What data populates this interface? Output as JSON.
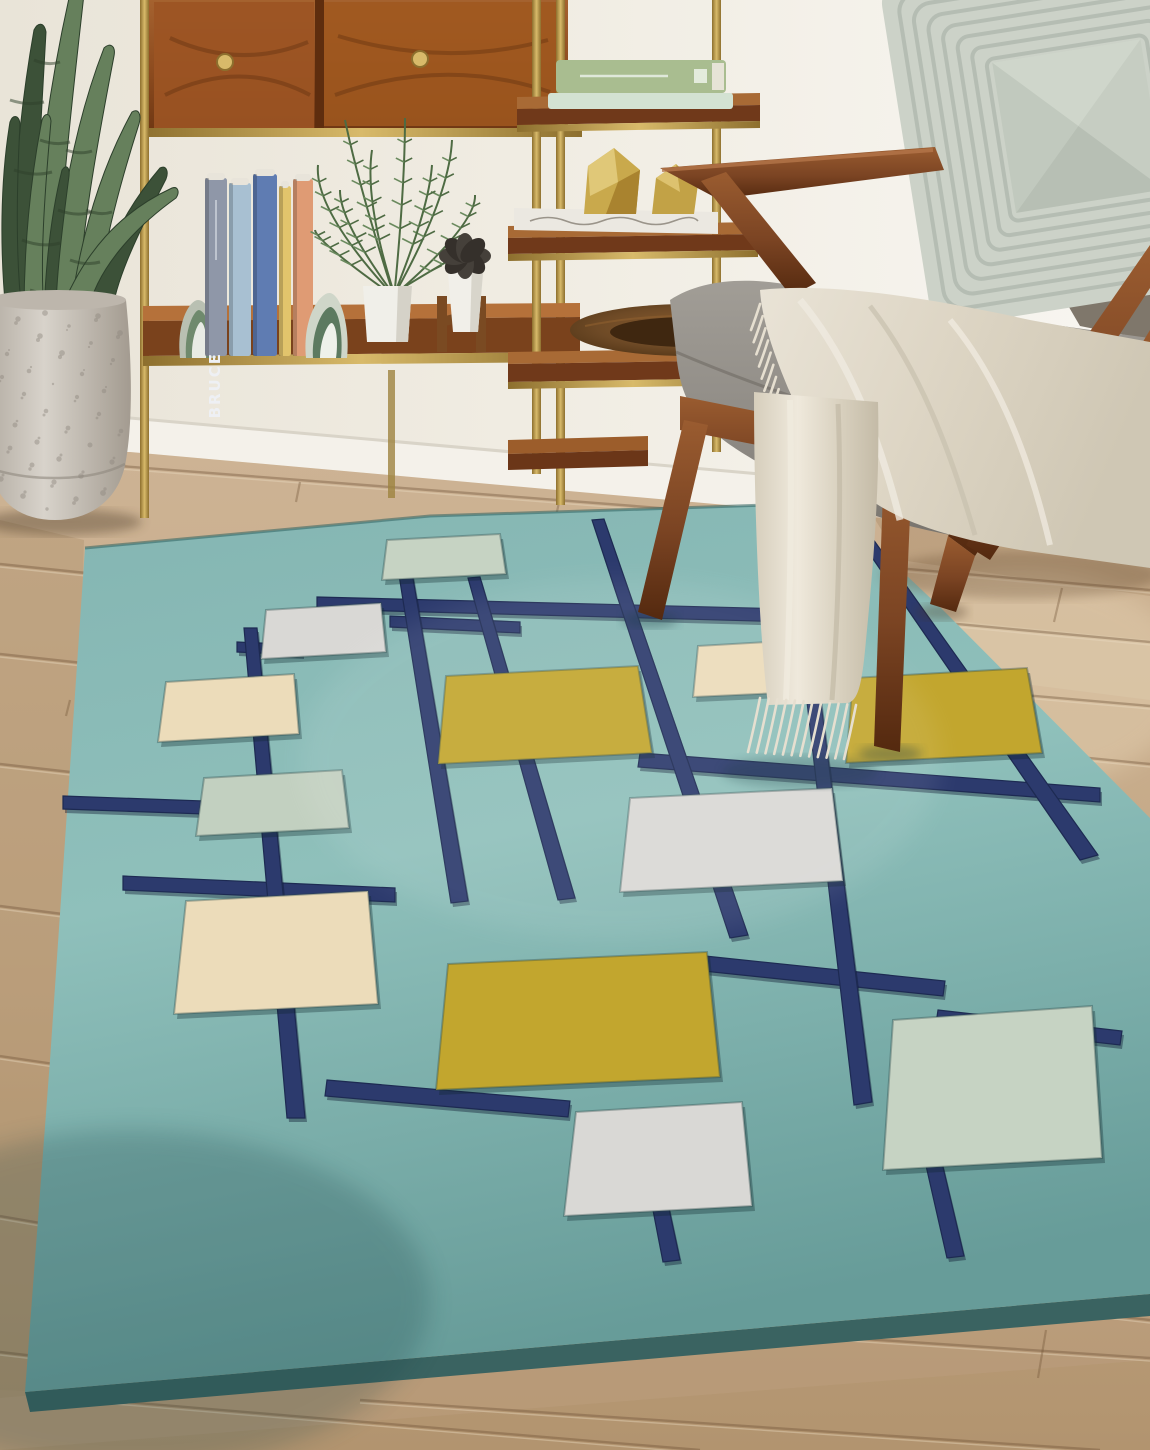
{
  "texts": {
    "alt": "Living room corner with a teal mid-century area rug with navy grid lines and cream, white, seafoam and chartreuse squares; walnut cabinet and brass etagere shelves with books and plants; snake plant in a speckled concrete pot; walnut armchair with gray cushions, ribbed sage pillow and a cream fringed throw on a light oak wood floor.",
    "book_spine": "BRUCE"
  },
  "palette": {
    "wall": "#eeeade",
    "wall_right": "#f7f5f0",
    "baseboard": "#f4f1ea",
    "baseboard_line": "#d9d4c8",
    "floor": "#c9af8f",
    "floor_dark": "#b0926e",
    "floor_light": "#e6d3b4",
    "seam": "#6e5034",
    "seam_light": "#e9d8ba",
    "rug": "#87b8b4",
    "rug_light": "#97c5bf",
    "rug_deep": "#5f9390",
    "rug_edge": "#3a6361",
    "navy": "#2c3a6d",
    "navy_dark": "#1d2a52",
    "walnut": "#7b4423",
    "walnut_light": "#9a5c30",
    "walnut_dark": "#4a2410",
    "brass": "#ab8a3c",
    "brass_light": "#dcc06c",
    "wood_shelf": "#95521f",
    "wood_shelf_light": "#b5713a",
    "cushion": "#928e87",
    "cushion_dark": "#6f6b64",
    "back_cushion": "#7f776b",
    "pillow": "#ccd2c8",
    "pillow_line": "#aeb6ac",
    "pillow_center": "#c6cdc2",
    "throw": "#ded7c7",
    "throw_light": "#efeae0",
    "throw_shadow": "#beb6a4",
    "pot": "#cfc9c1",
    "pot_speckle": "#8f887f",
    "plant": "#3c5138",
    "plant_light": "#66805c",
    "plant_band": "#2e4029",
    "palm": "#4e6b43",
    "palm_light": "#6a8a5e",
    "bowl": "#6e4a26",
    "bowl_dark": "#3f2710",
    "seafoam": "#c6d3c3",
    "white_square": "#d9d8d5",
    "cream": "#ecdcba",
    "mint": "#c2d0c0",
    "yellow": "#c2a62e",
    "book_gray_blue": "#8f97a8",
    "book_light_blue": "#a8c0d2",
    "book_blue": "#5f7cb2",
    "book_yellow": "#e2c46c",
    "book_coral": "#df9b74",
    "book_green": "#a9bd90",
    "book_mint": "#d3e2d2",
    "book_white": "#ebe8e1",
    "book_label_color": "#eef0f4"
  },
  "rug": {
    "outline": [
      [
        85,
        548
      ],
      [
        430,
        516
      ],
      [
        830,
        503
      ],
      [
        943,
        610
      ],
      [
        1150,
        818
      ],
      [
        1150,
        1294
      ],
      [
        25,
        1392
      ],
      [
        50,
        1060
      ]
    ],
    "edge_band": [
      [
        25,
        1392
      ],
      [
        1150,
        1294
      ],
      [
        1150,
        1316
      ],
      [
        30,
        1412
      ]
    ],
    "squares": [
      {
        "name": "rug-square-seafoam-top",
        "color": "seafoam",
        "pts": [
          [
            387,
            540
          ],
          [
            500,
            534
          ],
          [
            506,
            574
          ],
          [
            382,
            580
          ]
        ]
      },
      {
        "name": "rug-square-white-upper",
        "color": "white_square",
        "pts": [
          [
            266,
            610
          ],
          [
            381,
            603
          ],
          [
            386,
            652
          ],
          [
            261,
            659
          ]
        ]
      },
      {
        "name": "rug-square-cream-left",
        "color": "cream",
        "pts": [
          [
            166,
            682
          ],
          [
            294,
            674
          ],
          [
            299,
            734
          ],
          [
            158,
            742
          ]
        ]
      },
      {
        "name": "rug-square-mint-left",
        "color": "mint",
        "pts": [
          [
            204,
            778
          ],
          [
            342,
            770
          ],
          [
            349,
            828
          ],
          [
            196,
            836
          ]
        ]
      },
      {
        "name": "rug-square-cream-center",
        "color": "cream",
        "pts": [
          [
            698,
            646
          ],
          [
            835,
            638
          ],
          [
            841,
            690
          ],
          [
            693,
            697
          ]
        ]
      },
      {
        "name": "rug-square-yellow-left",
        "color": "yellow",
        "pts": [
          [
            446,
            676
          ],
          [
            638,
            666
          ],
          [
            652,
            753
          ],
          [
            438,
            764
          ]
        ]
      },
      {
        "name": "rug-square-yellow-right",
        "color": "yellow",
        "pts": [
          [
            853,
            678
          ],
          [
            1027,
            668
          ],
          [
            1042,
            753
          ],
          [
            846,
            763
          ]
        ]
      },
      {
        "name": "rug-square-white-center",
        "color": "white_square",
        "pts": [
          [
            630,
            798
          ],
          [
            832,
            788
          ],
          [
            843,
            881
          ],
          [
            620,
            892
          ]
        ]
      },
      {
        "name": "rug-square-cream-bottom",
        "color": "cream",
        "pts": [
          [
            186,
            901
          ],
          [
            368,
            891
          ],
          [
            378,
            1004
          ],
          [
            174,
            1014
          ]
        ]
      },
      {
        "name": "rug-square-yellow-bottom",
        "color": "yellow",
        "pts": [
          [
            448,
            964
          ],
          [
            707,
            952
          ],
          [
            720,
            1077
          ],
          [
            436,
            1090
          ]
        ]
      },
      {
        "name": "rug-square-white-bottom",
        "color": "white_square",
        "pts": [
          [
            576,
            1112
          ],
          [
            742,
            1102
          ],
          [
            752,
            1206
          ],
          [
            564,
            1216
          ]
        ]
      },
      {
        "name": "rug-square-seafoam-bottom",
        "color": "seafoam",
        "pts": [
          [
            893,
            1020
          ],
          [
            1092,
            1006
          ],
          [
            1102,
            1158
          ],
          [
            883,
            1170
          ]
        ]
      }
    ],
    "lines": [
      {
        "pts": [
          [
            317,
            597
          ],
          [
            830,
            610
          ],
          [
            830,
            623
          ],
          [
            317,
            609
          ]
        ]
      },
      {
        "pts": [
          [
            63,
            796
          ],
          [
            345,
            806
          ],
          [
            345,
            819
          ],
          [
            63,
            809
          ]
        ]
      },
      {
        "pts": [
          [
            123,
            876
          ],
          [
            395,
            888
          ],
          [
            395,
            902
          ],
          [
            123,
            890
          ]
        ]
      },
      {
        "pts": [
          [
            640,
            753
          ],
          [
            1100,
            788
          ],
          [
            1100,
            802
          ],
          [
            638,
            767
          ]
        ]
      },
      {
        "pts": [
          [
            705,
            956
          ],
          [
            945,
            981
          ],
          [
            943,
            996
          ],
          [
            703,
            971
          ]
        ]
      },
      {
        "pts": [
          [
            327,
            1080
          ],
          [
            570,
            1101
          ],
          [
            568,
            1117
          ],
          [
            325,
            1096
          ]
        ]
      },
      {
        "pts": [
          [
            938,
            1010
          ],
          [
            1122,
            1031
          ],
          [
            1120,
            1045
          ],
          [
            936,
            1024
          ]
        ]
      },
      {
        "pts": [
          [
            390,
            616
          ],
          [
            520,
            622
          ],
          [
            520,
            633
          ],
          [
            390,
            627
          ]
        ]
      },
      {
        "pts": [
          [
            237,
            642
          ],
          [
            302,
            645
          ],
          [
            302,
            655
          ],
          [
            237,
            652
          ]
        ]
      },
      {
        "pts": [
          [
            244,
            628
          ],
          [
            257,
            628
          ],
          [
            305,
            1118
          ],
          [
            287,
            1118
          ]
        ]
      },
      {
        "pts": [
          [
            396,
            556
          ],
          [
            409,
            555
          ],
          [
            468,
            901
          ],
          [
            451,
            903
          ]
        ]
      },
      {
        "pts": [
          [
            468,
            578
          ],
          [
            480,
            577
          ],
          [
            575,
            898
          ],
          [
            558,
            900
          ]
        ]
      },
      {
        "pts": [
          [
            592,
            520
          ],
          [
            604,
            519
          ],
          [
            748,
            935
          ],
          [
            730,
            938
          ]
        ]
      },
      {
        "pts": [
          [
            836,
            505
          ],
          [
            848,
            504
          ],
          [
            1098,
            855
          ],
          [
            1080,
            860
          ]
        ]
      },
      {
        "pts": [
          [
            800,
            642
          ],
          [
            813,
            641
          ],
          [
            872,
            1102
          ],
          [
            854,
            1105
          ]
        ]
      },
      {
        "pts": [
          [
            652,
            1205
          ],
          [
            668,
            1204
          ],
          [
            680,
            1260
          ],
          [
            663,
            1262
          ]
        ]
      },
      {
        "pts": [
          [
            922,
            1148
          ],
          [
            938,
            1146
          ],
          [
            964,
            1256
          ],
          [
            947,
            1258
          ]
        ]
      },
      {
        "pts": [
          [
            1052,
            1034
          ],
          [
            1066,
            1032
          ],
          [
            1094,
            1148
          ],
          [
            1078,
            1151
          ]
        ]
      }
    ]
  },
  "floor": {
    "seams": [
      [
        120,
        466,
        840,
        522
      ],
      [
        620,
        544,
        1150,
        590
      ],
      [
        700,
        600,
        1150,
        642
      ],
      [
        645,
        662,
        1150,
        706
      ],
      [
        766,
        726,
        1150,
        764
      ],
      [
        862,
        802,
        1150,
        836
      ],
      [
        902,
        884,
        1150,
        914
      ],
      [
        942,
        964,
        1150,
        990
      ],
      [
        982,
        1064,
        1150,
        1086
      ],
      [
        1022,
        1184,
        1150,
        1204
      ],
      [
        992,
        1302,
        1150,
        1320
      ],
      [
        0,
        564,
        96,
        574
      ],
      [
        0,
        654,
        92,
        664
      ],
      [
        0,
        764,
        88,
        774
      ],
      [
        0,
        906,
        78,
        916
      ],
      [
        0,
        1056,
        68,
        1066
      ],
      [
        0,
        1216,
        58,
        1226
      ],
      [
        30,
        1394,
        700,
        1450
      ],
      [
        360,
        1400,
        1100,
        1450
      ],
      [
        820,
        1336,
        1150,
        1358
      ],
      [
        0,
        1352,
        86,
        1362
      ]
    ],
    "ticks": [
      [
        1062,
        588,
        1054,
        622
      ],
      [
        994,
        762,
        986,
        800
      ],
      [
        1108,
        902,
        1100,
        944
      ],
      [
        1046,
        1330,
        1038,
        1378
      ],
      [
        300,
        482,
        296,
        502
      ],
      [
        560,
        498,
        556,
        516
      ],
      [
        70,
        700,
        66,
        716
      ],
      [
        50,
        1120,
        46,
        1136
      ]
    ]
  },
  "shelf_books": [
    {
      "x": 205,
      "w": 22,
      "top": 178,
      "color": "book_gray_blue",
      "label": "BRUCE"
    },
    {
      "x": 229,
      "w": 22,
      "top": 183,
      "color": "book_light_blue",
      "label": ""
    },
    {
      "x": 253,
      "w": 24,
      "top": 174,
      "color": "book_blue",
      "label": ""
    },
    {
      "x": 279,
      "w": 12,
      "top": 186,
      "color": "book_yellow",
      "label": ""
    },
    {
      "x": 293,
      "w": 20,
      "top": 179,
      "color": "book_coral",
      "label": ""
    }
  ],
  "pillow": {
    "rings": 7
  },
  "throw": {
    "fringe_side": {
      "x0": 760,
      "y0": 304,
      "x1": 792,
      "y1": 450,
      "count": 13,
      "len": 26,
      "drift": -9
    },
    "fringe_bottom": {
      "x0": 760,
      "y0": 698,
      "x1": 856,
      "y1": 705,
      "count": 12,
      "len": 54,
      "drift": -12
    }
  },
  "snake_plant": {
    "leaves": [
      {
        "d": "M14,312 C10,220 18,120 34,30 C38,22 44,22 46,32 C40,140 34,230 36,312 Z",
        "tone": 0
      },
      {
        "d": "M30,313 C34,190 50,80 72,-15 C78,-22 84,-18 84,-6 C70,120 58,220 58,313 Z",
        "tone": 1
      },
      {
        "d": "M6,313 C0,252 0,182 10,122 C13,114 19,115 20,124 C16,200 16,262 22,313 Z",
        "tone": 0
      },
      {
        "d": "M52,312 C58,210 76,120 104,48 C110,42 116,46 114,56 C96,150 80,240 78,312 Z",
        "tone": 1
      },
      {
        "d": "M44,313 C46,260 52,210 62,170 C66,164 70,167 69,176 C62,230 56,280 56,313 Z",
        "tone": 0
      },
      {
        "d": "M70,313 C80,240 100,170 132,112 C138,108 142,114 139,124 C118,190 100,260 96,313 Z",
        "tone": 1
      },
      {
        "d": "M88,313 C100,260 124,210 160,168 C166,165 169,171 166,179 C140,230 116,278 112,313 Z",
        "tone": 0
      },
      {
        "d": "M60,312 C84,252 120,212 172,188 C178,186 180,192 176,198 C134,228 96,270 88,312 Z",
        "tone": 1
      },
      {
        "d": "M24,313 C24,250 30,180 42,120 C45,112 50,113 51,121 C44,200 40,262 44,313 Z",
        "tone": 1
      }
    ],
    "bands": [
      "M10,100 q18,6 34,2",
      "M34,60 q14,6 26,2",
      "M14,170 q20,7 38,2",
      "M40,140 q16,6 30,2",
      "M58,210 q18,7 34,2",
      "M22,240 q20,8 38,3",
      "M66,150 q14,5 26,1",
      "M86,210 q14,6 26,2",
      "M30,290 q20,7 40,2",
      "M70,260 q16,6 30,2"
    ]
  },
  "palm": {
    "fronds": [
      [
        390,
        292,
        318,
        165,
        -40
      ],
      [
        392,
        290,
        345,
        120,
        -10
      ],
      [
        395,
        288,
        405,
        118,
        5
      ],
      [
        397,
        290,
        452,
        140,
        25
      ],
      [
        398,
        292,
        475,
        195,
        40
      ],
      [
        396,
        292,
        470,
        250,
        30
      ],
      [
        388,
        292,
        315,
        230,
        -35
      ],
      [
        393,
        290,
        372,
        150,
        -18
      ],
      [
        396,
        290,
        432,
        165,
        15
      ],
      [
        391,
        291,
        340,
        190,
        -26
      ]
    ]
  }
}
